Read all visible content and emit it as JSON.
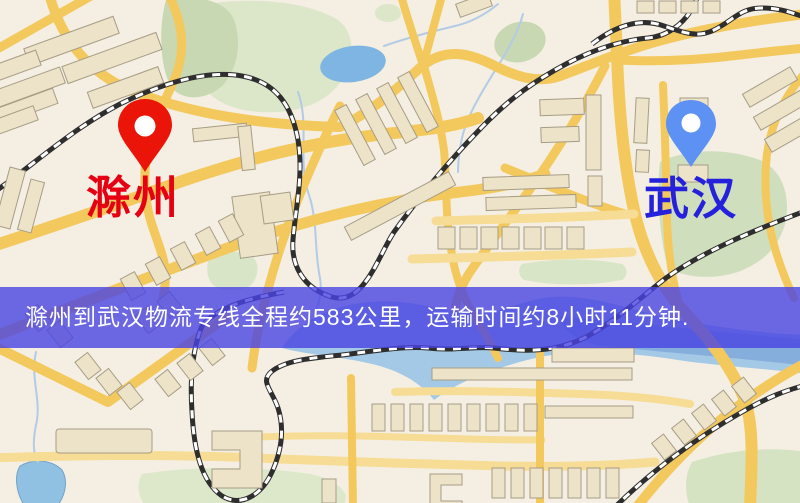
{
  "banner": {
    "text": "滁州到武汉物流专线全程约583公里，运输时间约8小时11分钟.",
    "background": "rgba(72,68,226,0.8)",
    "text_color": "#ffffff"
  },
  "markers": {
    "origin": {
      "label": "滁州",
      "label_color": "#e60012",
      "pin_color": "#ea1508",
      "pin_icon": "red-map-pin-icon"
    },
    "destination": {
      "label": "武汉",
      "label_color": "#2420dc",
      "pin_color": "#5d91f3",
      "pin_icon": "blue-map-pin-icon"
    }
  },
  "route": {
    "origin_city": "滁州",
    "destination_city": "武汉",
    "distance_km": "583",
    "duration": "8小时11分钟"
  },
  "map_colors": {
    "land": "#f4efe2",
    "road": "#f3c95e",
    "road_light": "#f6dc95",
    "park": "#c8d8b2",
    "park_light": "#dbe7c8",
    "water": "#a3c9e6",
    "lake": "#7fb5e2",
    "building_fill": "#ece3c8",
    "building_stroke": "#a79d86",
    "railway_dark": "#2e2e2e",
    "railway_light": "#ffffff"
  }
}
